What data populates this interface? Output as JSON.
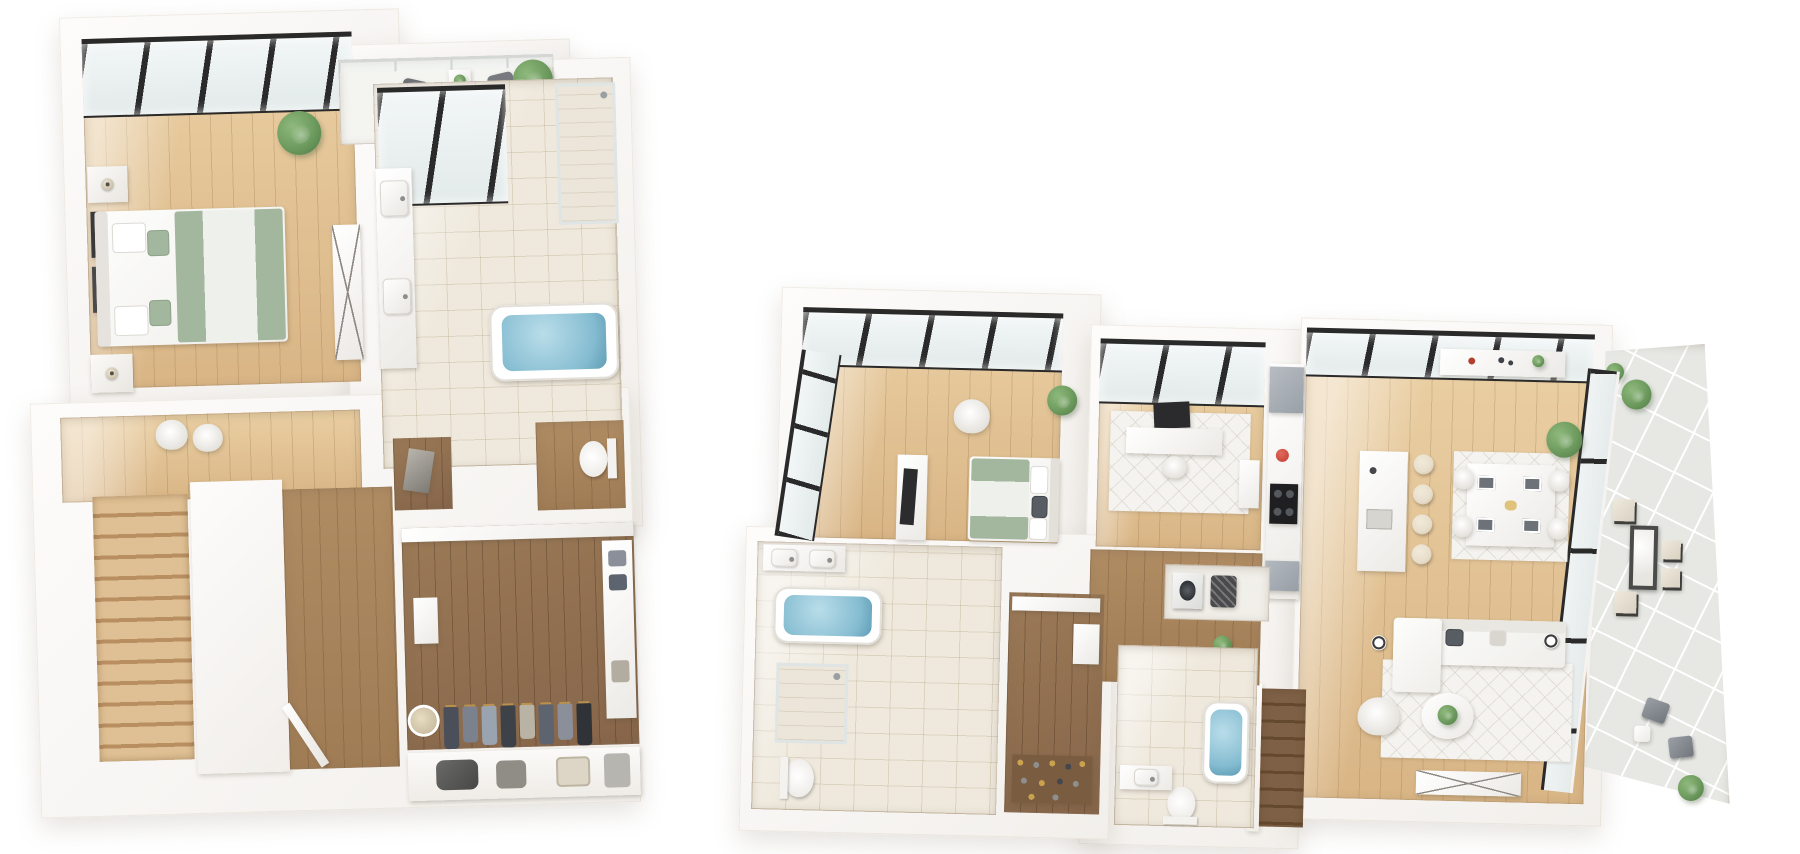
{
  "scene": {
    "title": "3D isometric floor plan renderings, two levels side by side",
    "background": "#ffffff",
    "plan_count": 2
  },
  "colors": {
    "bg": "#ffffff",
    "wall": "#faf9f7",
    "wallEdge": "#e7e3dd",
    "woodLight": "#d9b585",
    "woodLight2": "#eacfa3",
    "woodHall": "#b08c63",
    "woodDark": "#86654a",
    "tile": "#efe9dd",
    "balconyTile": "#e7e8e4",
    "frame": "#2a2a2a",
    "sage": "#a3b69e",
    "water": "#85bcd1",
    "plant": "#6d9a5e",
    "plantDark": "#4e7a44",
    "gray": "#aab0b6",
    "charcoal": "#2e2e2e",
    "cream": "#e7ddcb",
    "rug": "#f4f3ef",
    "accentRed": "#c23a2f",
    "brass": "#b9914d"
  },
  "plans": {
    "upper": {
      "label": "upper-floor-plan",
      "rooms": {
        "bedroom": {
          "label": "Primary bedroom",
          "floor": "light wood",
          "furniture": [
            "bed-with-sage-striped-duvet",
            "headboard",
            "pillows",
            "nightstand-left",
            "nightstand-right",
            "table-lamps",
            "wall-art-frames",
            "monstera-plant",
            "mirror-console",
            "skylight-window-wall"
          ]
        },
        "balcony": {
          "label": "Balcony terrace",
          "floor": "white deck",
          "furniture": [
            "glass-railing",
            "cafe-chair-left",
            "cafe-chair-right",
            "side-table-with-plant",
            "potted-palm"
          ]
        },
        "bathroom": {
          "label": "Primary bathroom",
          "floor": "cream tile",
          "furniture": [
            "skylight-window",
            "double-vanity",
            "walk-in-shower",
            "soaking-tub-with-water"
          ]
        },
        "wc": {
          "label": "Water closet",
          "floor": "wood",
          "furniture": [
            "toilet"
          ]
        },
        "nook": {
          "label": "Storage nook",
          "floor": "dark wood",
          "furniture": [
            "leaning-mirror"
          ]
        },
        "hallway": {
          "label": "Hallway landing",
          "floor": "light wood",
          "furniture": [
            "pouf-pair",
            "open-door"
          ]
        },
        "stairs": {
          "label": "Staircase down",
          "floor": "wood treads",
          "furniture": [
            "stair-wall"
          ]
        },
        "closet": {
          "label": "Walk-in closet",
          "floor": "dark wood",
          "furniture": [
            "hanging-clothes-rail",
            "wall-cabinet",
            "round-mirror",
            "shelving-tower",
            "folded-clothes",
            "duffel-bag",
            "tote-bag",
            "suitcase"
          ]
        }
      }
    },
    "main": {
      "label": "main-floor-plan",
      "rooms": {
        "bedroom": {
          "label": "Bedroom two",
          "floor": "light wood",
          "furniture": [
            "bed-with-sage-striped-duvet",
            "tv-console",
            "flat-tv",
            "armchair",
            "plant",
            "window-wall",
            "skylight-band"
          ]
        },
        "office": {
          "label": "Office den",
          "floor": "light wood",
          "furniture": [
            "desk",
            "monitor",
            "desk-chair",
            "area-rug",
            "storage-unit",
            "skylight-band"
          ]
        },
        "kitchen": {
          "label": "Galley kitchen",
          "floor": "wood",
          "furniture": [
            "refrigerator",
            "counter-run",
            "red-pot",
            "gas-range",
            "base-cabinet"
          ]
        },
        "great_room": {
          "label": "Great room",
          "floor": "light wood",
          "furniture": [
            "window-wall",
            "kitchen-island",
            "bar-stools-4",
            "dining-rug",
            "dining-table",
            "dining-chairs-4",
            "placemats-4",
            "sideboard",
            "tall-plant",
            "sofa",
            "throw-pillows",
            "floor-lamp-left",
            "floor-lamp-right",
            "accent-chair",
            "round-coffee-table-with-plant",
            "living-rug",
            "tv-console-x-legs"
          ]
        },
        "laundry": {
          "label": "Laundry closet",
          "furniture": [
            "washer",
            "laundry-hamper"
          ]
        },
        "bathroom1": {
          "label": "Ensuite bathroom",
          "floor": "cream tile",
          "furniture": [
            "vanity",
            "soaking-tub-with-water",
            "glass-shower",
            "toilet"
          ]
        },
        "closet": {
          "label": "Walk-in closet",
          "floor": "dark wood",
          "furniture": [
            "shelf",
            "shoe-rows",
            "storage-baskets"
          ]
        },
        "bathroom2": {
          "label": "Guest bathroom",
          "floor": "cream tile",
          "furniture": [
            "tub-with-water",
            "toilet",
            "vanity"
          ]
        },
        "stairs": {
          "label": "Staircase down",
          "floor": "dark wood treads",
          "furniture": []
        },
        "hallway": {
          "label": "Hallway",
          "floor": "wood",
          "furniture": [
            "plant-small"
          ]
        },
        "terrace": {
          "label": "Wraparound terrace",
          "floor": "stone tile",
          "furniture": [
            "glass-enclosure",
            "fire-table",
            "ottomans-4",
            "potted-plants",
            "lounge-chairs-2",
            "side-table",
            "floor-plant"
          ]
        }
      }
    }
  }
}
